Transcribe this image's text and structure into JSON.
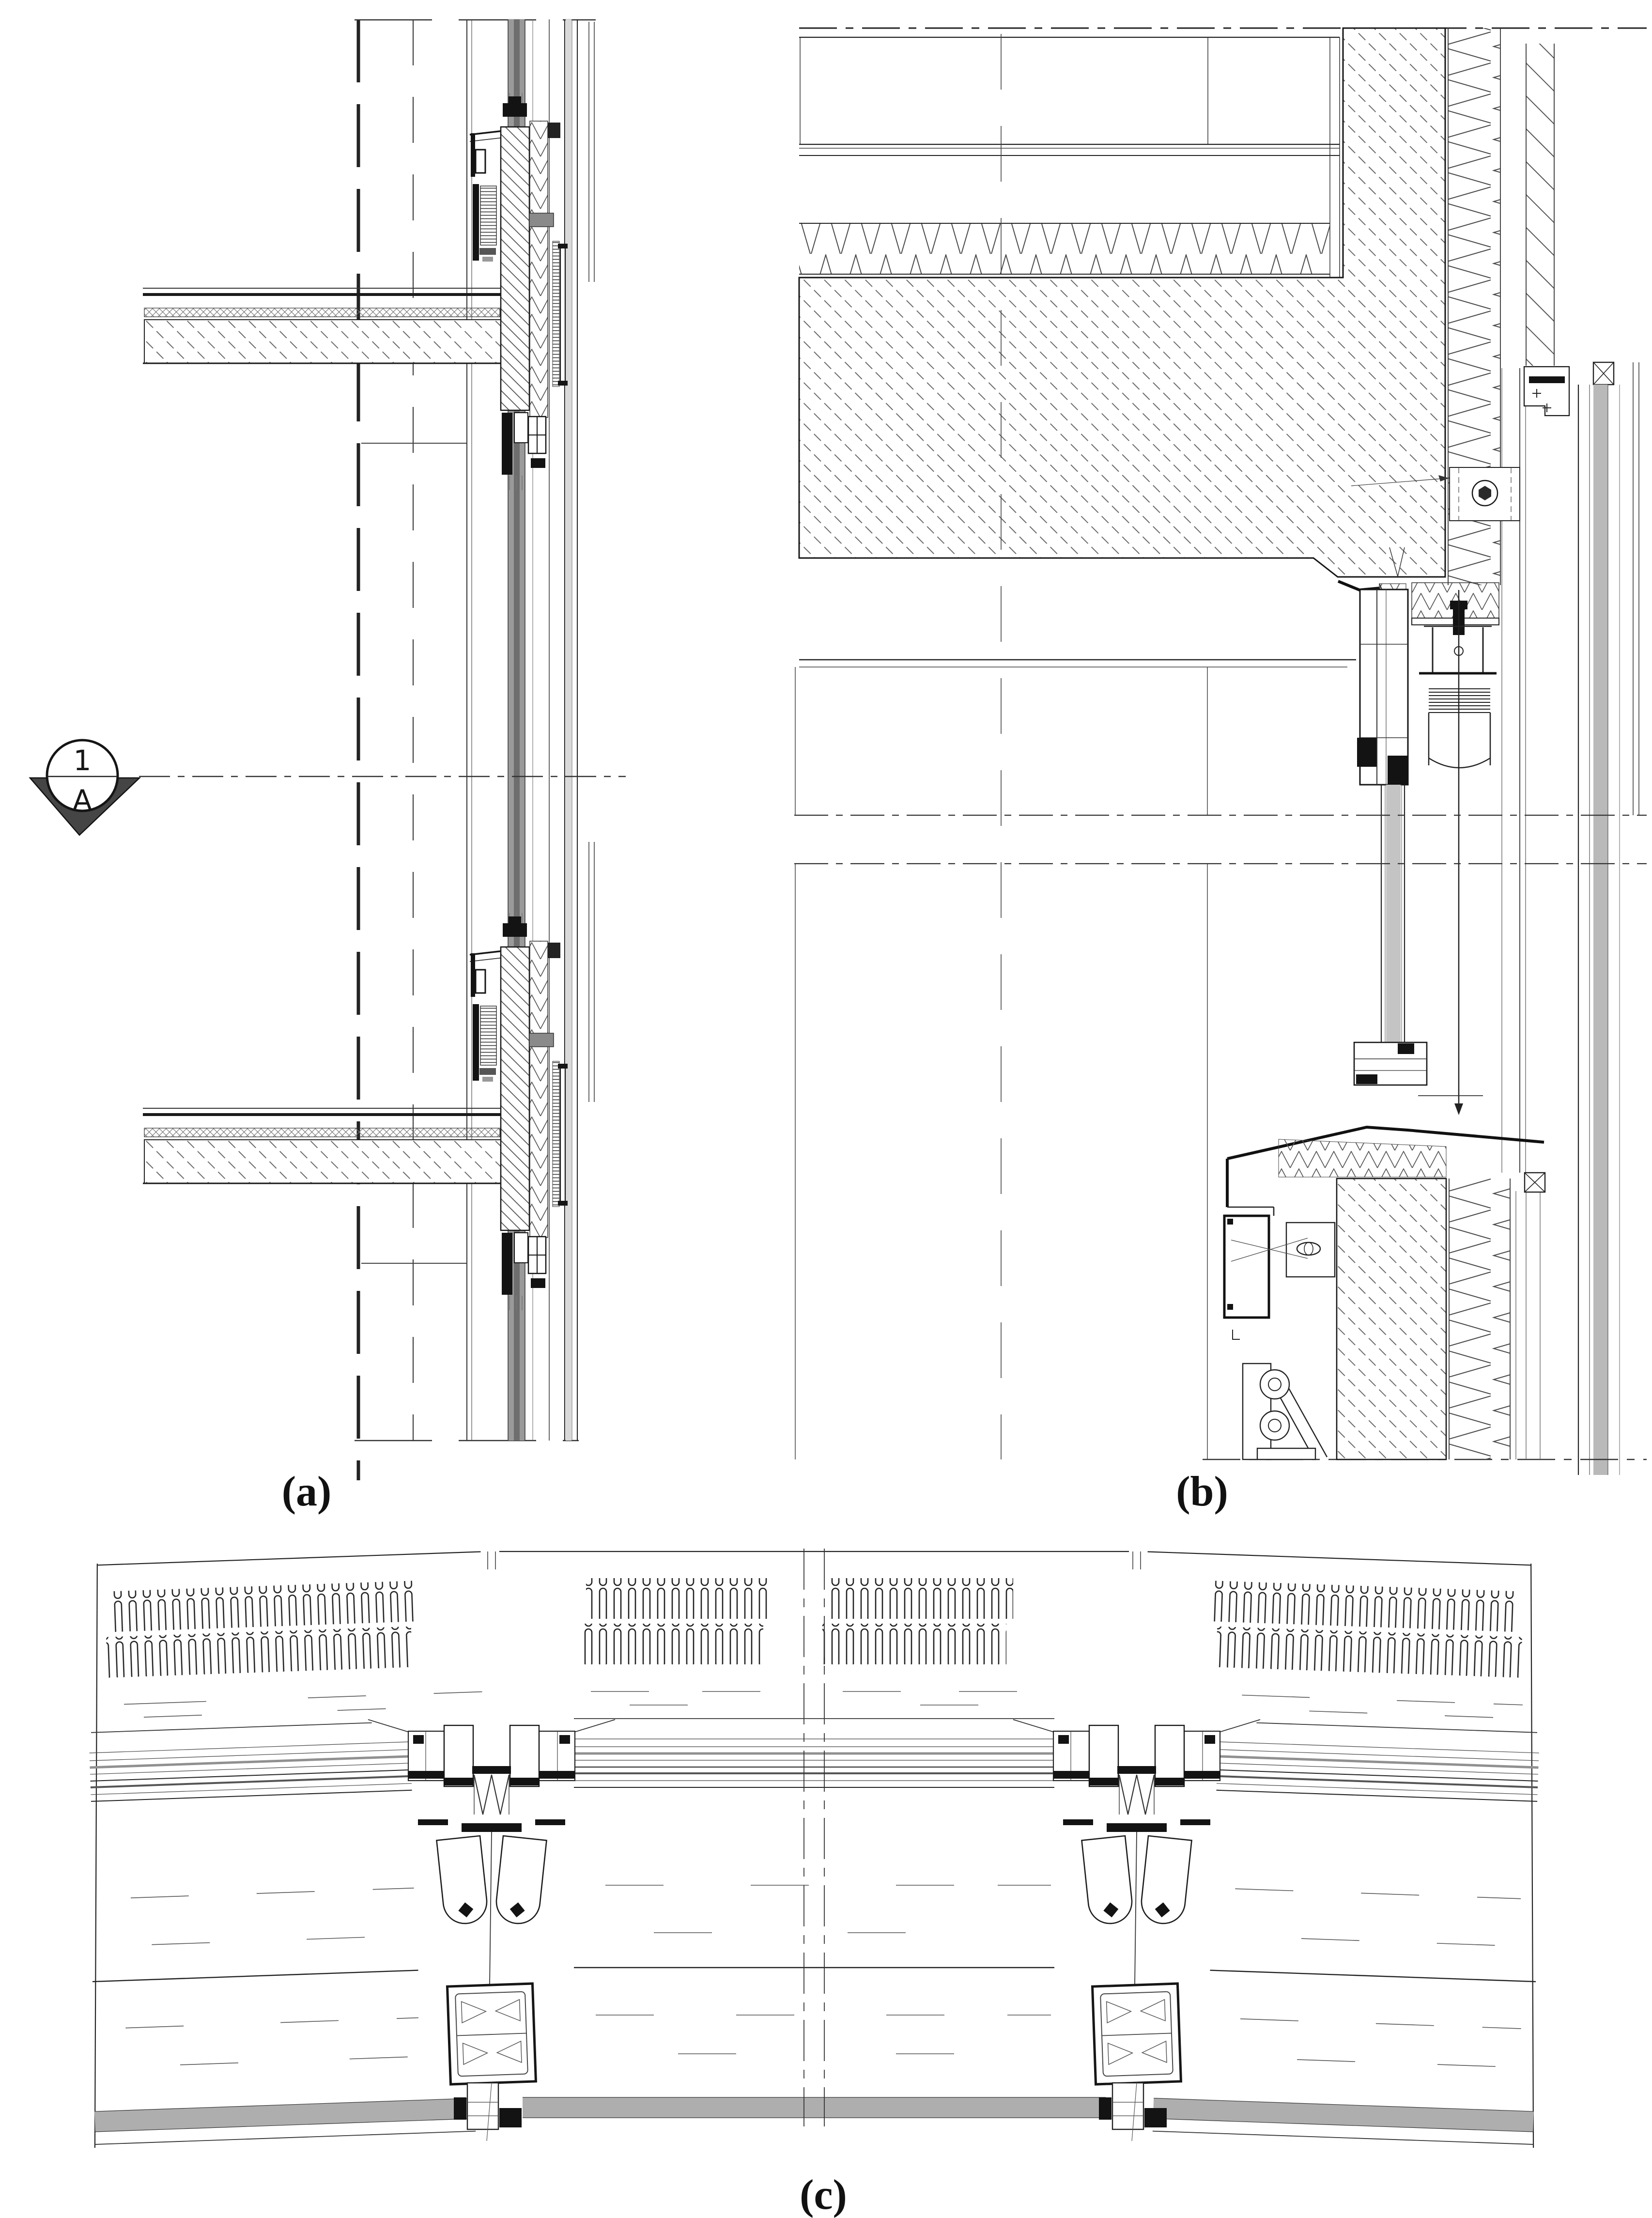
{
  "figure": {
    "kind": "architectural construction detail drawing, 3 panels",
    "panels": [
      {
        "id": "a",
        "label": "(a)"
      },
      {
        "id": "b",
        "label": "(b)"
      },
      {
        "id": "c",
        "label": "(c)"
      }
    ]
  },
  "labels": {
    "a": "(a)",
    "b": "(b)",
    "c": "(c)"
  },
  "section_marker": {
    "number": "1",
    "letter": "A"
  },
  "colors": {
    "background": "#ffffff",
    "line": "#1a1a1a",
    "hatch": "#555555",
    "mullion_gray": "#8f8f8f",
    "glass_gray": "#b0b0b0",
    "marker_triangle": "#454545",
    "label_text": "#111111"
  }
}
